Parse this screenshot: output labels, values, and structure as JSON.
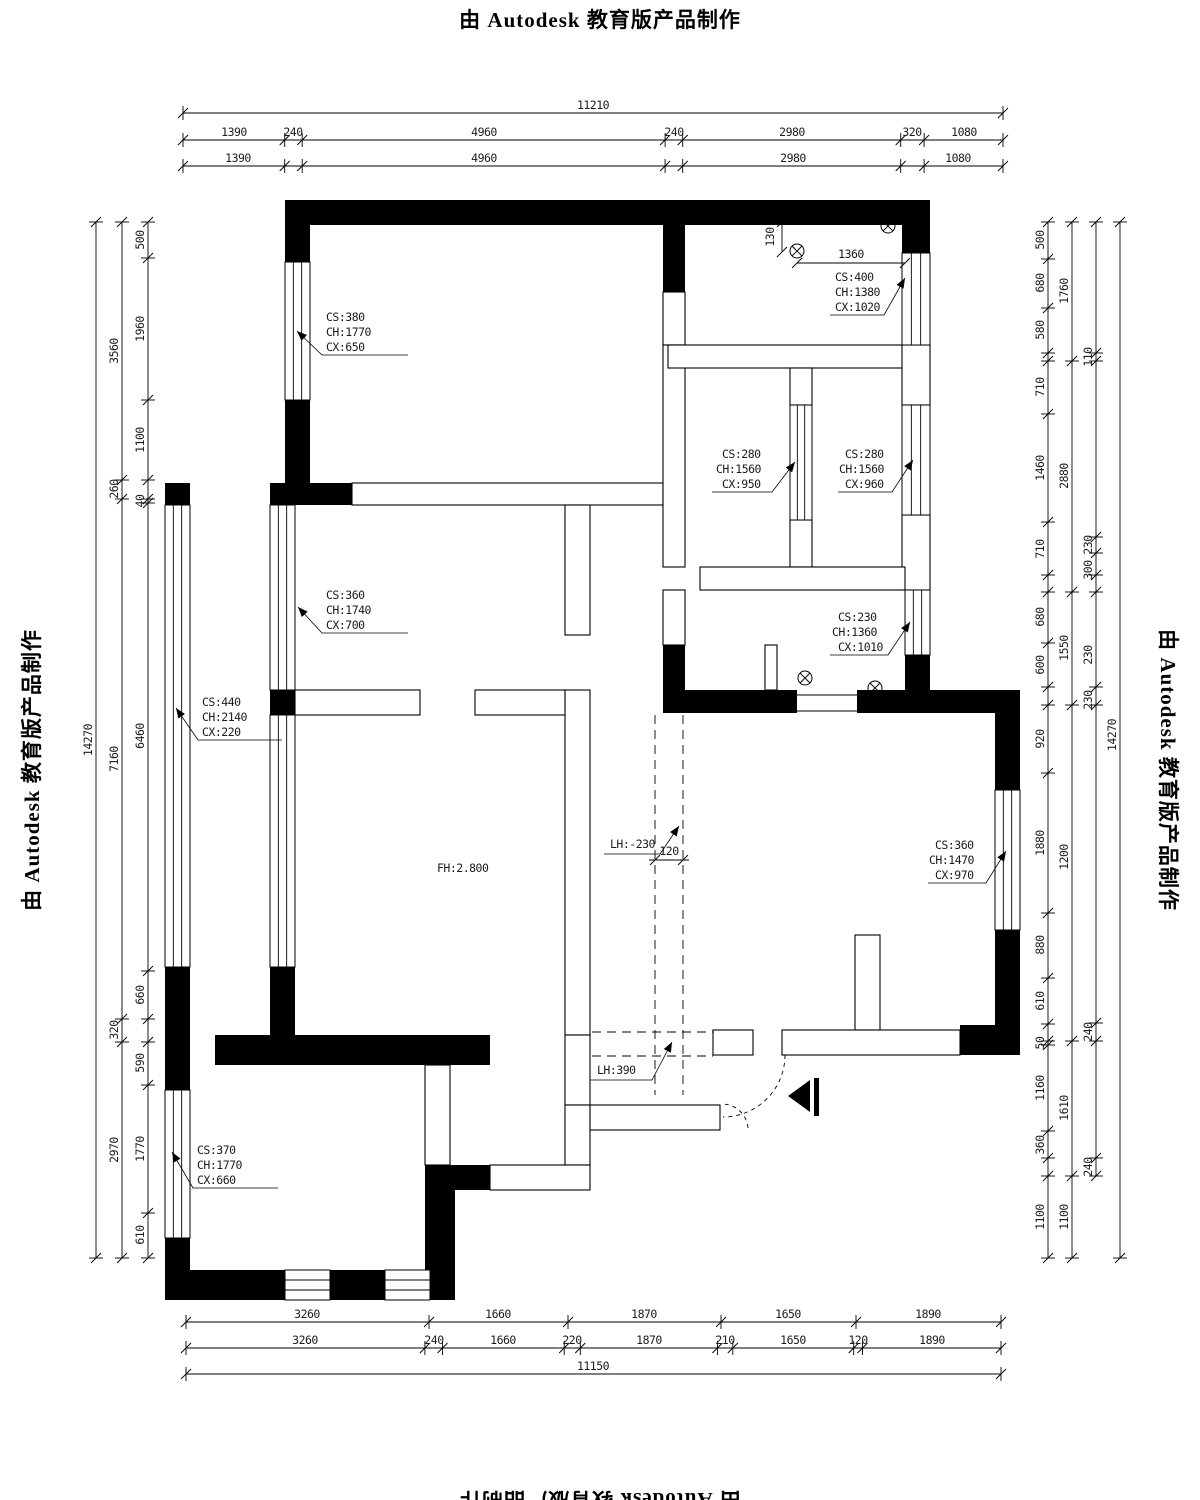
{
  "stamp": {
    "text": "由 Autodesk 教育版产品制作"
  },
  "dims": {
    "top_total": [
      "11210"
    ],
    "top_row1": [
      "1390",
      "240",
      "4960",
      "240",
      "2980",
      "320",
      "1080"
    ],
    "top_row2": [
      "1390",
      "4960",
      "2980",
      "1080"
    ],
    "bottom_row1": [
      "3260",
      "1660",
      "1870",
      "1650",
      "1890"
    ],
    "bottom_row2": [
      "3260",
      "240",
      "1660",
      "220",
      "1870",
      "210",
      "1650",
      "120",
      "1890"
    ],
    "bottom_total": [
      "11150"
    ],
    "left_total": [
      "14270"
    ],
    "left_outer": [
      "3560",
      "260",
      "7160",
      "320",
      "2970"
    ],
    "left_inner": [
      "500",
      "1960",
      "1100",
      "40",
      "6460",
      "660",
      "590",
      "1770",
      "610"
    ],
    "right_inner": [
      "500",
      "680",
      "580",
      "710",
      "1460",
      "710",
      "680",
      "600",
      "920",
      "1880",
      "880",
      "610",
      "50",
      "1160",
      "360",
      "1100"
    ],
    "right_middle": [
      "1760",
      "2880",
      "1550",
      "1200",
      "1610",
      "1100"
    ],
    "right_outer": [
      "110",
      "230",
      "300",
      "230",
      "230",
      "240",
      "240"
    ],
    "right_total": [
      "14270"
    ],
    "misc": {
      "v130": "130",
      "h1360": "1360",
      "beam120": "120"
    }
  },
  "labels": {
    "win_tl": [
      "CS:380",
      "CH:1770",
      "CX:650"
    ],
    "win_tr": [
      "CS:400",
      "CH:1380",
      "CX:1020"
    ],
    "win_room_l": [
      "CS:280",
      "CH:1560",
      "CX:950"
    ],
    "win_room_r": [
      "CS:280",
      "CH:1560",
      "CX:960"
    ],
    "win_inner_up": [
      "CS:360",
      "CH:1740",
      "CX:700"
    ],
    "win_left_long": [
      "CS:440",
      "CH:2140",
      "CX:220"
    ],
    "win_cs230": [
      "CS:230",
      "CH:1360",
      "CX:1010"
    ],
    "win_right": [
      "CS:360",
      "CH:1470",
      "CX:970"
    ],
    "win_bl": [
      "CS:370",
      "CH:1770",
      "CX:660"
    ],
    "floor_height": "FH:2.800",
    "beam_upper": "LH:-230",
    "beam_lower": "LH:390"
  }
}
